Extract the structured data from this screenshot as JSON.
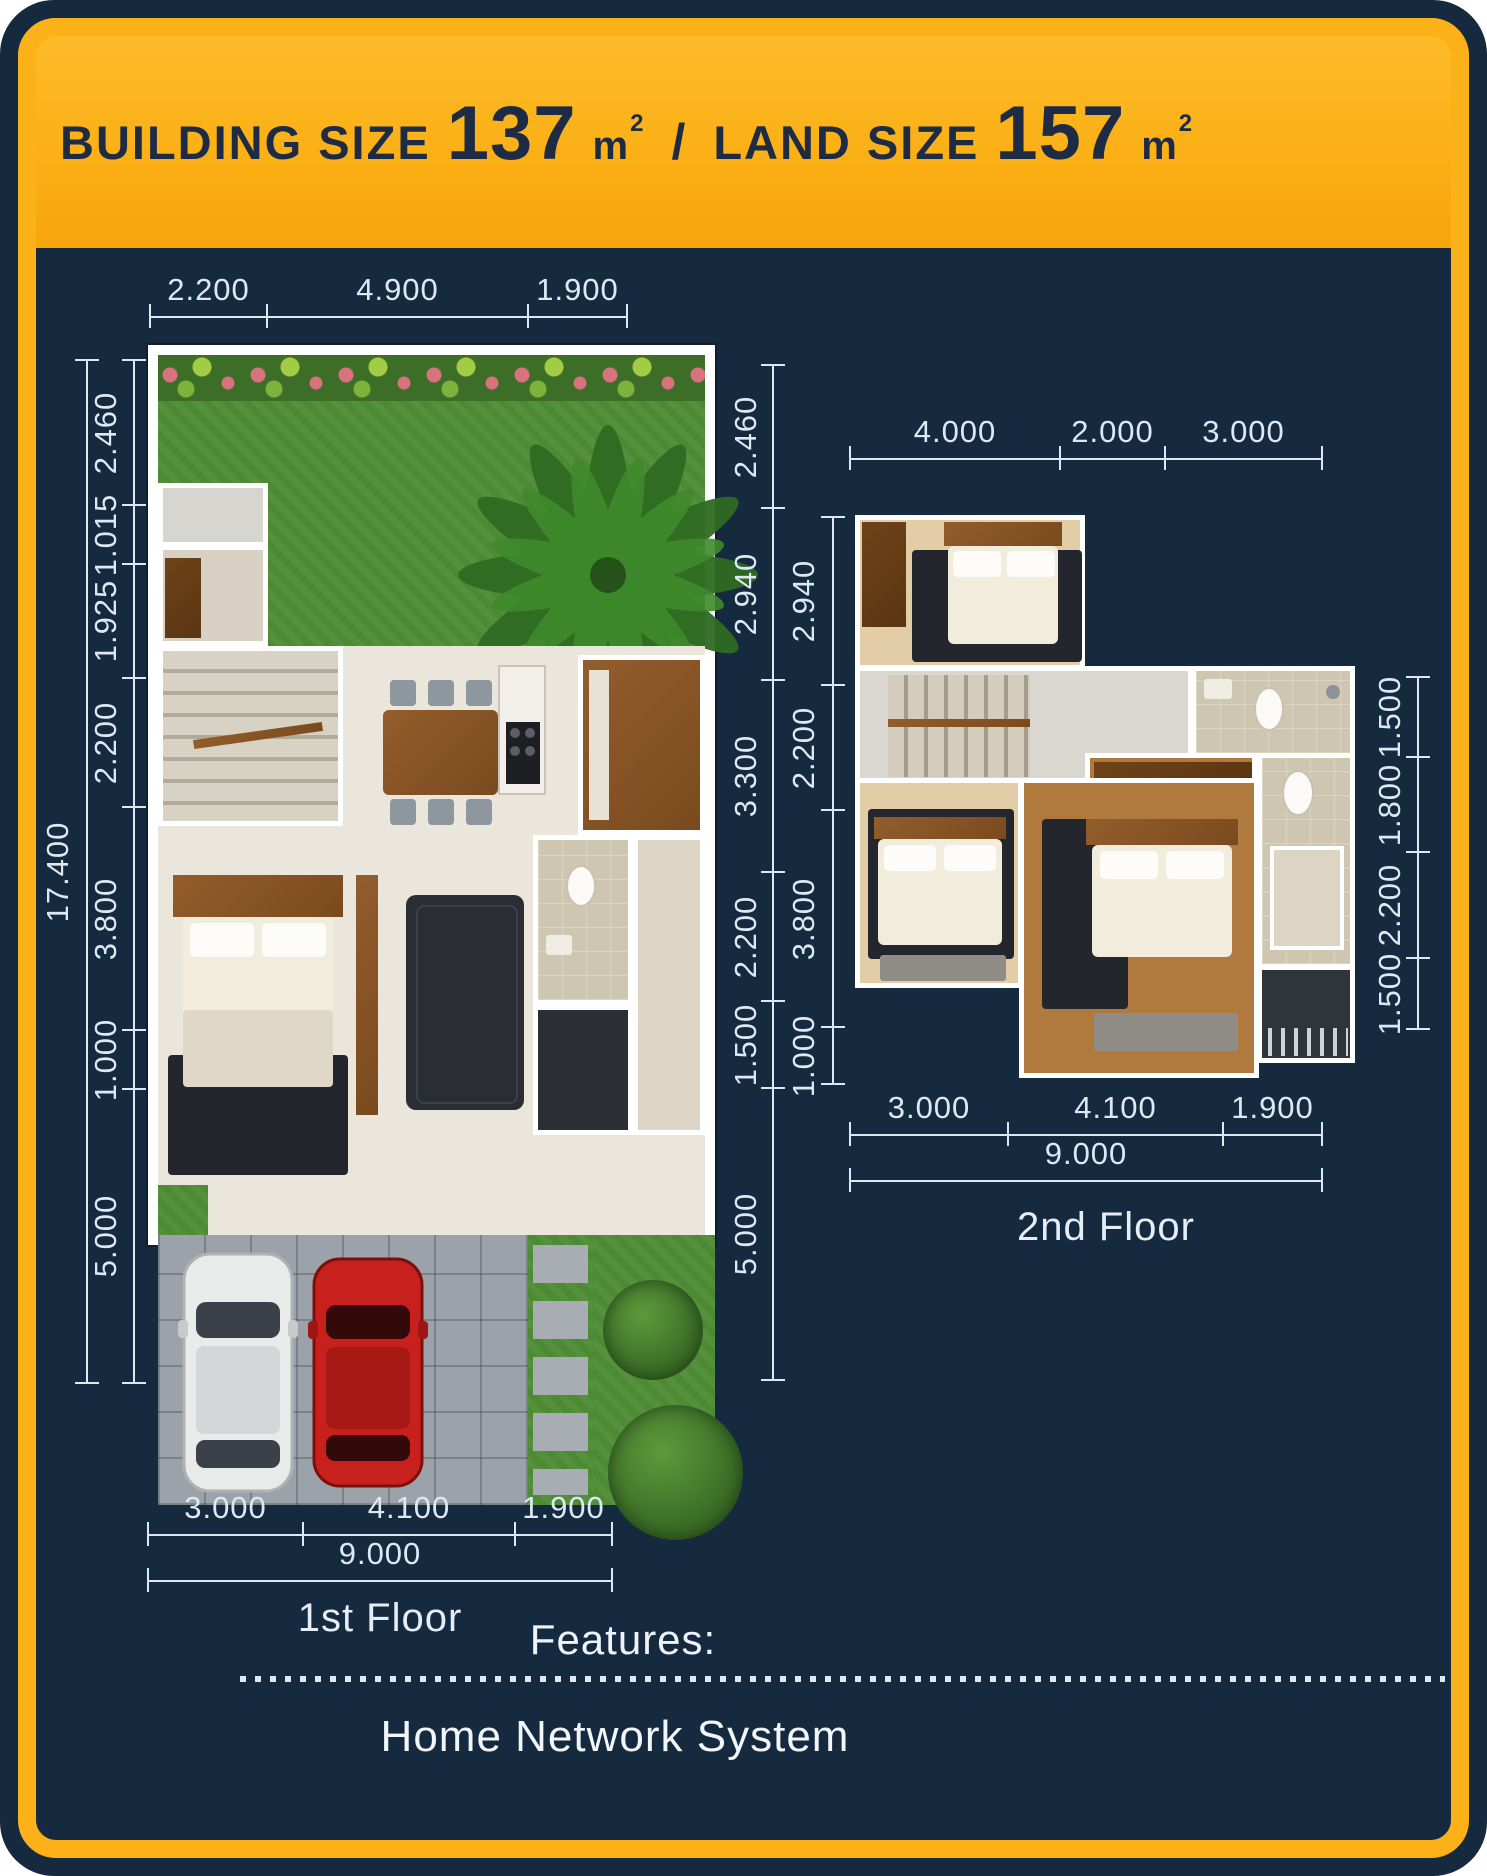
{
  "header": {
    "building_label": "BUILDING SIZE",
    "building_value": "137",
    "unit_base": "m",
    "unit_exp": "2",
    "separator": "/",
    "land_label": "LAND SIZE",
    "land_value": "157"
  },
  "colors": {
    "navy_background": "#15293f",
    "accent_yellow": "#fbb117",
    "dimension_ink": "#dde8f2",
    "title_ink": "#1d2b45"
  },
  "floor1": {
    "caption": "1st Floor",
    "dims_top": [
      "2.200",
      "4.900",
      "1.900"
    ],
    "dims_left_overall": "17.400",
    "dims_left": [
      "2.460",
      "1.015",
      "1.925",
      "2.200",
      "3.800",
      "1.000",
      "5.000"
    ],
    "dims_right": [
      "2.460",
      "2.940",
      "3.300",
      "2.200",
      "1.500",
      "5.000"
    ],
    "dims_bottom": [
      "3.000",
      "4.100",
      "1.900"
    ],
    "dims_bottom_overall": "9.000"
  },
  "floor2": {
    "caption": "2nd Floor",
    "dims_top": [
      "4.000",
      "2.000",
      "3.000"
    ],
    "dims_left": [
      "2.940",
      "2.200",
      "3.800",
      "1.000"
    ],
    "dims_right": [
      "1.500",
      "1.800",
      "2.200",
      "1.500"
    ],
    "dims_bottom": [
      "3.000",
      "4.100",
      "1.900"
    ],
    "dims_bottom_overall": "9.000"
  },
  "features": {
    "label": "Features:",
    "items": [
      "Home Network System"
    ]
  }
}
